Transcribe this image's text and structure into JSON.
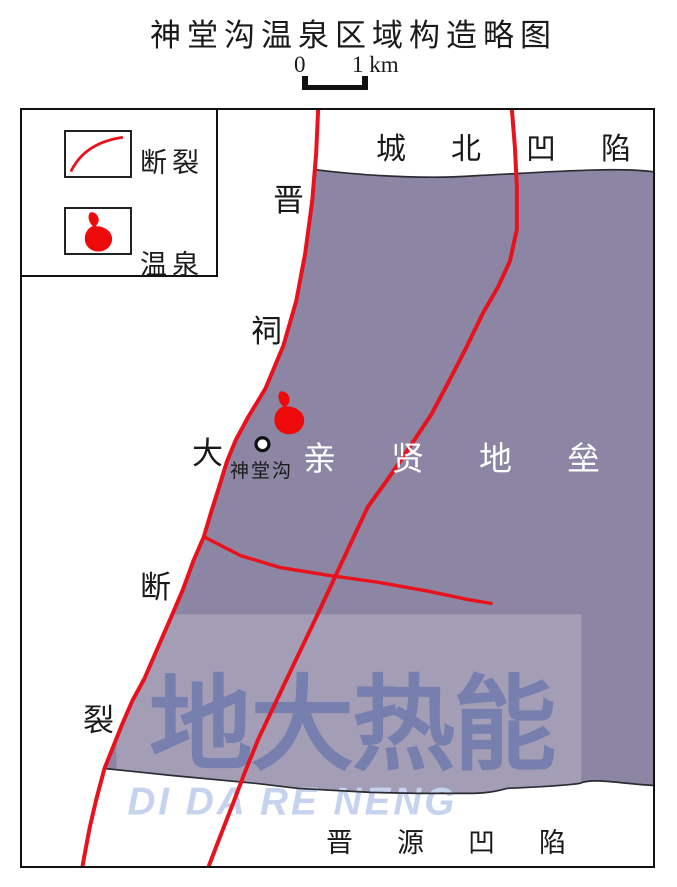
{
  "title": "神堂沟温泉区域构造略图",
  "scale_bar": {
    "start_label": "0",
    "end_label": "1 km"
  },
  "legend": {
    "fault_label": "断裂",
    "spring_label": "温泉"
  },
  "map": {
    "top_region_label": "城北凹陷",
    "horst_label": "亲贤地垒",
    "bottom_region_label": "晋源凹陷",
    "site_label": "神堂沟",
    "fault_name_chars": [
      "晋",
      "祠",
      "大",
      "断",
      "裂"
    ],
    "colors": {
      "horst_fill": "#8c86a4",
      "fault_red": "#e8111c",
      "spring_red": "#ee0a0a",
      "boundary_black": "#2b2b33"
    }
  },
  "watermark": {
    "cjk": "地大热能",
    "latin": "DI DA RE NENG"
  }
}
